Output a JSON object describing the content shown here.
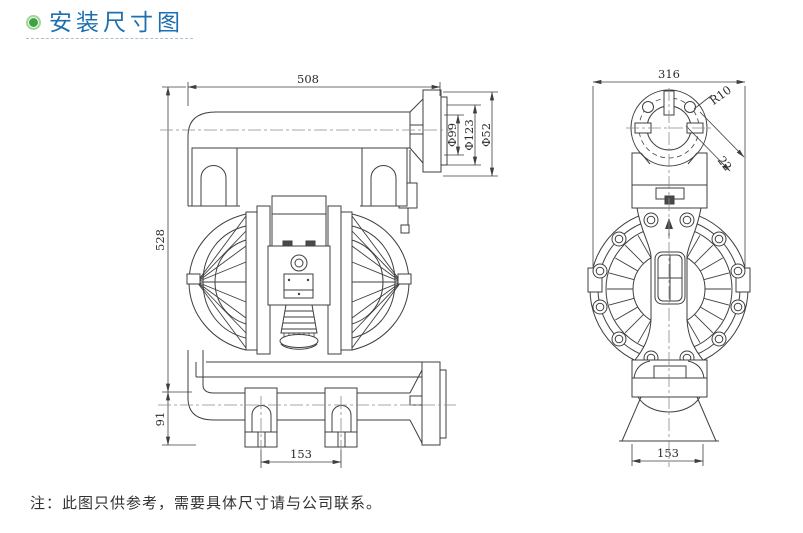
{
  "header": {
    "title": "安装尺寸图"
  },
  "note": {
    "text": "注：此图只供参考，需要具体尺寸请与公司联系。"
  },
  "front_view": {
    "dim_overall_width": "508",
    "dim_overall_height": "528",
    "dim_base_height": "91",
    "dim_foot_spacing": "153",
    "dim_port_bore": "Φ99",
    "dim_port_flange": "Φ123",
    "dim_port_outer": "Φ52"
  },
  "side_view": {
    "dim_overall_width": "316",
    "dim_corner_radius": "R10",
    "dim_flange_offset": "22",
    "dim_base_width": "153"
  },
  "colors": {
    "accent": "#1d6fb0",
    "bullet_green": "#3ea344",
    "line": "#3f3f3f"
  }
}
